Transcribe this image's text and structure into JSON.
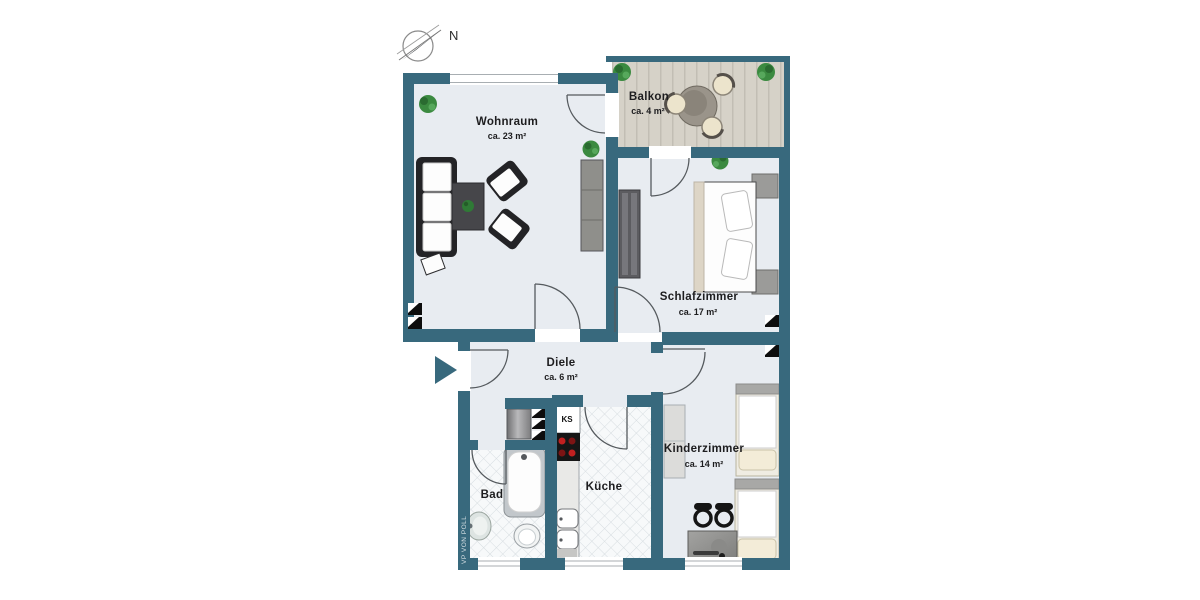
{
  "compass": {
    "label": "N"
  },
  "watermark": {
    "text": "VP VON POLL"
  },
  "rooms": {
    "wohnraum": {
      "name": "Wohnraum",
      "area": "ca. 23 m²"
    },
    "balkon": {
      "name": "Balkon",
      "area": "ca. 4 m²"
    },
    "schlafzimmer": {
      "name": "Schlafzimmer",
      "area": "ca. 17 m²"
    },
    "diele": {
      "name": "Diele",
      "area": "ca. 6 m²"
    },
    "bad": {
      "name": "Bad"
    },
    "kueche": {
      "name": "Küche",
      "fridge_label": "KS"
    },
    "kinderzimmer": {
      "name": "Kinderzimmer",
      "area": "ca. 14 m²"
    }
  },
  "colors": {
    "wall": "#38697d",
    "floor": "#e8ecf1",
    "tile_bg": "#f7f9fa",
    "deck": "#d6d2c8",
    "arc": "#555a5e",
    "label": "#1d1d1f",
    "plant": "#2f7a36",
    "entrance_arrow": "#38697d",
    "stove_burner": "#c22020"
  }
}
